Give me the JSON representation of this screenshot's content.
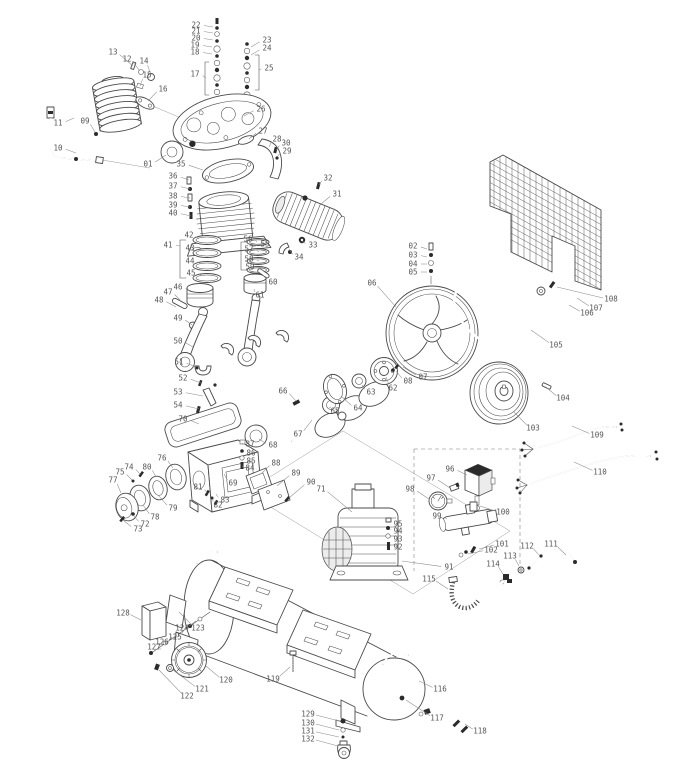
{
  "colors": {
    "background": "#ffffff",
    "line": "#4a4a4a",
    "dark_fill": "#2b2b2b",
    "label": "#555555",
    "leader": "#8c8c8c",
    "shade": "#ececec"
  },
  "diagram": {
    "labels": [
      {
        "n": "01",
        "x": 148,
        "y": 164,
        "tx": 166,
        "ty": 155
      },
      {
        "n": "02",
        "x": 413,
        "y": 246,
        "tx": 427,
        "ty": 249
      },
      {
        "n": "03",
        "x": 413,
        "y": 255,
        "tx": 427,
        "ty": 257
      },
      {
        "n": "04",
        "x": 413,
        "y": 264,
        "tx": 427,
        "ty": 264
      },
      {
        "n": "05",
        "x": 413,
        "y": 272,
        "tx": 427,
        "ty": 272
      },
      {
        "n": "06",
        "x": 372,
        "y": 283,
        "tx": 396,
        "ty": 307
      },
      {
        "n": "07",
        "x": 423,
        "y": 377,
        "tx": 403,
        "ty": 367
      },
      {
        "n": "08",
        "x": 408,
        "y": 381,
        "tx": 396,
        "ty": 371
      },
      {
        "n": "09",
        "x": 85,
        "y": 121,
        "tx": 95,
        "ty": 132
      },
      {
        "n": "10",
        "x": 58,
        "y": 148,
        "tx": 76,
        "ty": 153
      },
      {
        "n": "11",
        "x": 58,
        "y": 123,
        "tx": 74,
        "ty": 118
      },
      {
        "n": "12",
        "x": 127,
        "y": 59,
        "tx": 140,
        "ty": 71
      },
      {
        "n": "13",
        "x": 113,
        "y": 52,
        "tx": 133,
        "ty": 66
      },
      {
        "n": "14",
        "x": 144,
        "y": 61,
        "tx": 151,
        "ty": 75
      },
      {
        "n": "15",
        "x": 147,
        "y": 75,
        "tx": 140,
        "ty": 86
      },
      {
        "n": "16",
        "x": 163,
        "y": 89,
        "tx": 148,
        "ty": 101
      },
      {
        "n": "17",
        "x": 195,
        "y": 74,
        "tx": 206,
        "ty": 78
      },
      {
        "n": "18",
        "x": 195,
        "y": 52,
        "tx": 212,
        "ty": 54
      },
      {
        "n": "19",
        "x": 195,
        "y": 45,
        "tx": 212,
        "ty": 47
      },
      {
        "n": "20",
        "x": 196,
        "y": 38,
        "tx": 213,
        "ty": 40
      },
      {
        "n": "21",
        "x": 196,
        "y": 31,
        "tx": 213,
        "ty": 33
      },
      {
        "n": "22",
        "x": 196,
        "y": 25,
        "tx": 213,
        "ty": 27
      },
      {
        "n": "23",
        "x": 267,
        "y": 40,
        "tx": 251,
        "ty": 47
      },
      {
        "n": "24",
        "x": 267,
        "y": 48,
        "tx": 251,
        "ty": 55
      },
      {
        "n": "25",
        "x": 269,
        "y": 68,
        "tx": 259,
        "ty": 70
      },
      {
        "n": "26",
        "x": 261,
        "y": 109,
        "tx": 244,
        "ty": 116
      },
      {
        "n": "27",
        "x": 263,
        "y": 131,
        "tx": 249,
        "ty": 139
      },
      {
        "n": "28",
        "x": 277,
        "y": 139,
        "tx": 269,
        "ty": 147
      },
      {
        "n": "29",
        "x": 287,
        "y": 151,
        "tx": 277,
        "ty": 157
      },
      {
        "n": "30",
        "x": 286,
        "y": 143,
        "tx": 276,
        "ty": 150
      },
      {
        "n": "31",
        "x": 337,
        "y": 194,
        "tx": 321,
        "ty": 204
      },
      {
        "n": "32",
        "x": 328,
        "y": 178,
        "tx": 319,
        "ty": 185
      },
      {
        "n": "33",
        "x": 313,
        "y": 245,
        "tx": 302,
        "ty": 241
      },
      {
        "n": "34",
        "x": 299,
        "y": 257,
        "tx": 289,
        "ty": 249
      },
      {
        "n": "35",
        "x": 181,
        "y": 164,
        "tx": 203,
        "ty": 170
      },
      {
        "n": "36",
        "x": 173,
        "y": 176,
        "tx": 189,
        "ty": 180
      },
      {
        "n": "37",
        "x": 173,
        "y": 186,
        "tx": 190,
        "ty": 189
      },
      {
        "n": "38",
        "x": 173,
        "y": 196,
        "tx": 190,
        "ty": 198
      },
      {
        "n": "39",
        "x": 173,
        "y": 205,
        "tx": 190,
        "ty": 207
      },
      {
        "n": "40",
        "x": 173,
        "y": 213,
        "tx": 191,
        "ty": 216
      },
      {
        "n": "41",
        "x": 168,
        "y": 245,
        "tx": 180,
        "ty": 246
      },
      {
        "n": "42",
        "x": 189,
        "y": 235,
        "tx": 199,
        "ty": 239
      },
      {
        "n": "43",
        "x": 190,
        "y": 248,
        "tx": 200,
        "ty": 251
      },
      {
        "n": "44",
        "x": 190,
        "y": 261,
        "tx": 200,
        "ty": 263
      },
      {
        "n": "45",
        "x": 191,
        "y": 273,
        "tx": 201,
        "ty": 275
      },
      {
        "n": "46",
        "x": 178,
        "y": 287,
        "tx": 191,
        "ty": 292
      },
      {
        "n": "47",
        "x": 168,
        "y": 292,
        "tx": 180,
        "ty": 300
      },
      {
        "n": "48",
        "x": 159,
        "y": 300,
        "tx": 176,
        "ty": 307
      },
      {
        "n": "49",
        "x": 178,
        "y": 318,
        "tx": 192,
        "ty": 325
      },
      {
        "n": "50",
        "x": 178,
        "y": 341,
        "tx": 193,
        "ty": 347
      },
      {
        "n": "51",
        "x": 179,
        "y": 362,
        "tx": 196,
        "ty": 367
      },
      {
        "n": "52",
        "x": 183,
        "y": 378,
        "tx": 201,
        "ty": 383
      },
      {
        "n": "53",
        "x": 178,
        "y": 392,
        "tx": 203,
        "ty": 396
      },
      {
        "n": "54",
        "x": 178,
        "y": 405,
        "tx": 199,
        "ty": 409
      },
      {
        "n": "55",
        "x": 265,
        "y": 244,
        "tx": 253,
        "ty": 247
      },
      {
        "n": "56",
        "x": 248,
        "y": 239,
        "tx": 257,
        "ty": 242
      },
      {
        "n": "57",
        "x": 249,
        "y": 249,
        "tx": 259,
        "ty": 252
      },
      {
        "n": "58",
        "x": 249,
        "y": 259,
        "tx": 259,
        "ty": 261
      },
      {
        "n": "59",
        "x": 250,
        "y": 267,
        "tx": 260,
        "ty": 269
      },
      {
        "n": "60",
        "x": 273,
        "y": 282,
        "tx": 263,
        "ty": 275
      },
      {
        "n": "61",
        "x": 260,
        "y": 295,
        "tx": 254,
        "ty": 289
      },
      {
        "n": "62",
        "x": 393,
        "y": 388,
        "tx": 386,
        "ty": 377
      },
      {
        "n": "63",
        "x": 371,
        "y": 392,
        "tx": 362,
        "ty": 385
      },
      {
        "n": "64",
        "x": 358,
        "y": 408,
        "tx": 341,
        "ty": 396
      },
      {
        "n": "65",
        "x": 335,
        "y": 411,
        "tx": 331,
        "ty": 407
      },
      {
        "n": "66",
        "x": 283,
        "y": 391,
        "tx": 296,
        "ty": 401
      },
      {
        "n": "67",
        "x": 298,
        "y": 434,
        "tx": 312,
        "ty": 420
      },
      {
        "n": "68",
        "x": 273,
        "y": 445,
        "tx": 259,
        "ty": 439
      },
      {
        "n": "69",
        "x": 233,
        "y": 483,
        "tx": 224,
        "ty": 474
      },
      {
        "n": "70",
        "x": 183,
        "y": 419,
        "tx": 199,
        "ty": 424
      },
      {
        "n": "71",
        "x": 321,
        "y": 489,
        "tx": 352,
        "ty": 512
      },
      {
        "n": "72",
        "x": 145,
        "y": 524,
        "tx": 134,
        "ty": 516
      },
      {
        "n": "73",
        "x": 138,
        "y": 529,
        "tx": 123,
        "ty": 520
      },
      {
        "n": "74",
        "x": 129,
        "y": 467,
        "tx": 140,
        "ty": 474
      },
      {
        "n": "75",
        "x": 120,
        "y": 472,
        "tx": 132,
        "ty": 480
      },
      {
        "n": "76",
        "x": 162,
        "y": 458,
        "tx": 173,
        "ty": 468
      },
      {
        "n": "77",
        "x": 113,
        "y": 480,
        "tx": 121,
        "ty": 493
      },
      {
        "n": "78",
        "x": 155,
        "y": 517,
        "tx": 143,
        "ty": 505
      },
      {
        "n": "79",
        "x": 173,
        "y": 508,
        "tx": 158,
        "ty": 495
      },
      {
        "n": "80",
        "x": 147,
        "y": 467,
        "tx": 156,
        "ty": 477
      },
      {
        "n": "81",
        "x": 198,
        "y": 487,
        "tx": 207,
        "ty": 493
      },
      {
        "n": "82",
        "x": 218,
        "y": 505,
        "tx": 213,
        "ty": 499
      },
      {
        "n": "83",
        "x": 225,
        "y": 500,
        "tx": 216,
        "ty": 494
      },
      {
        "n": "84",
        "x": 250,
        "y": 468,
        "tx": 243,
        "ty": 466
      },
      {
        "n": "85",
        "x": 251,
        "y": 461,
        "tx": 243,
        "ty": 459
      },
      {
        "n": "86",
        "x": 251,
        "y": 453,
        "tx": 243,
        "ty": 452
      },
      {
        "n": "87",
        "x": 250,
        "y": 444,
        "tx": 243,
        "ty": 443
      },
      {
        "n": "88",
        "x": 276,
        "y": 463,
        "tx": 262,
        "ty": 473
      },
      {
        "n": "89",
        "x": 296,
        "y": 473,
        "tx": 277,
        "ty": 486
      },
      {
        "n": "90",
        "x": 311,
        "y": 482,
        "tx": 289,
        "ty": 498
      },
      {
        "n": "91",
        "x": 449,
        "y": 567,
        "tx": 402,
        "ty": 561
      },
      {
        "n": "92",
        "x": 398,
        "y": 547,
        "tx": 390,
        "ty": 545
      },
      {
        "n": "93",
        "x": 398,
        "y": 539,
        "tx": 390,
        "ty": 537
      },
      {
        "n": "94",
        "x": 398,
        "y": 531,
        "tx": 390,
        "ty": 529
      },
      {
        "n": "95",
        "x": 398,
        "y": 524,
        "tx": 390,
        "ty": 521
      },
      {
        "n": "96",
        "x": 450,
        "y": 469,
        "tx": 467,
        "ty": 475
      },
      {
        "n": "97",
        "x": 431,
        "y": 478,
        "tx": 450,
        "ty": 488
      },
      {
        "n": "98",
        "x": 410,
        "y": 489,
        "tx": 429,
        "ty": 499
      },
      {
        "n": "99",
        "x": 437,
        "y": 516,
        "tx": 447,
        "ty": 519
      },
      {
        "n": "100",
        "x": 503,
        "y": 512,
        "tx": 480,
        "ty": 506
      },
      {
        "n": "101",
        "x": 502,
        "y": 544,
        "tx": 479,
        "ty": 549
      },
      {
        "n": "102",
        "x": 491,
        "y": 550,
        "tx": 468,
        "ty": 554
      },
      {
        "n": "103",
        "x": 533,
        "y": 428,
        "tx": 514,
        "ty": 412
      },
      {
        "n": "104",
        "x": 563,
        "y": 398,
        "tx": 547,
        "ty": 388
      },
      {
        "n": "105",
        "x": 556,
        "y": 345,
        "tx": 531,
        "ty": 330
      },
      {
        "n": "106",
        "x": 587,
        "y": 313,
        "tx": 569,
        "ty": 305
      },
      {
        "n": "107",
        "x": 596,
        "y": 308,
        "tx": 577,
        "ty": 298
      },
      {
        "n": "108",
        "x": 611,
        "y": 299,
        "tx": 557,
        "ty": 287
      },
      {
        "n": "109",
        "x": 597,
        "y": 435,
        "tx": 572,
        "ty": 426
      },
      {
        "n": "110",
        "x": 600,
        "y": 472,
        "tx": 574,
        "ty": 462
      },
      {
        "n": "111",
        "x": 551,
        "y": 544,
        "tx": 566,
        "ty": 555
      },
      {
        "n": "112",
        "x": 527,
        "y": 546,
        "tx": 539,
        "ty": 555
      },
      {
        "n": "113",
        "x": 510,
        "y": 556,
        "tx": 519,
        "ty": 566
      },
      {
        "n": "114",
        "x": 493,
        "y": 564,
        "tx": 503,
        "ty": 574
      },
      {
        "n": "115",
        "x": 429,
        "y": 579,
        "tx": 448,
        "ty": 589
      },
      {
        "n": "116",
        "x": 440,
        "y": 689,
        "tx": 419,
        "ty": 681
      },
      {
        "n": "117",
        "x": 437,
        "y": 718,
        "tx": 406,
        "ty": 700
      },
      {
        "n": "118",
        "x": 480,
        "y": 731,
        "tx": 465,
        "ty": 724
      },
      {
        "n": "119",
        "x": 273,
        "y": 679,
        "tx": 290,
        "ty": 667
      },
      {
        "n": "120",
        "x": 226,
        "y": 680,
        "tx": 206,
        "ty": 666
      },
      {
        "n": "121",
        "x": 202,
        "y": 689,
        "tx": 173,
        "ty": 670
      },
      {
        "n": "122",
        "x": 187,
        "y": 696,
        "tx": 159,
        "ty": 670
      },
      {
        "n": "123",
        "x": 198,
        "y": 628,
        "tx": 179,
        "ty": 612
      },
      {
        "n": "124",
        "x": 182,
        "y": 628,
        "tx": 196,
        "ty": 621
      },
      {
        "n": "125",
        "x": 175,
        "y": 637,
        "tx": 184,
        "ty": 630
      },
      {
        "n": "126",
        "x": 162,
        "y": 642,
        "tx": 172,
        "ty": 637
      },
      {
        "n": "127",
        "x": 154,
        "y": 647,
        "tx": 158,
        "ty": 649
      },
      {
        "n": "128",
        "x": 123,
        "y": 613,
        "tx": 141,
        "ty": 620
      },
      {
        "n": "129",
        "x": 308,
        "y": 714,
        "tx": 339,
        "ty": 721
      },
      {
        "n": "130",
        "x": 308,
        "y": 723,
        "tx": 339,
        "ty": 730
      },
      {
        "n": "131",
        "x": 308,
        "y": 731,
        "tx": 339,
        "ty": 737
      },
      {
        "n": "132",
        "x": 308,
        "y": 739,
        "tx": 338,
        "ty": 746
      }
    ]
  }
}
